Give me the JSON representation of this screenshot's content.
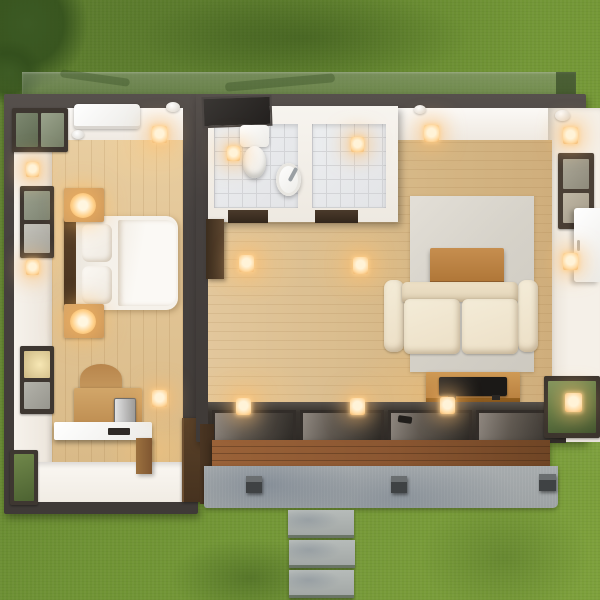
{
  "scene": {
    "type": "3d-architectural-render",
    "view": "top-down cutaway of a small container-style house on a lawn",
    "rooms": [
      {
        "name": "bedroom",
        "floor": "light wood with white tiled lounge strip"
      },
      {
        "name": "bathroom",
        "floor": "grey ceramic tile",
        "sections": [
          "wc",
          "shower"
        ]
      },
      {
        "name": "living-room",
        "floor": "light wood with grey rug"
      }
    ],
    "exterior": [
      "glass canopy strip",
      "sliding glass doors",
      "wooden deck fascia",
      "concrete patio",
      "three stepping stones",
      "lawn",
      "tree canopy"
    ]
  },
  "objects": {
    "lawn": "Lawn",
    "tree": "Tree canopy",
    "canopy": "Glass canopy over rear wall",
    "bedroom": "Bedroom",
    "bed": "Double bed with white duvet",
    "headboard": "Dark wood headboard",
    "pillow": "Pillow",
    "nightstand": "Nightstand with glowing lamp",
    "desk": "Wooden desk with computer",
    "chair": "Desk chair",
    "wardrobe": "Dark wood wardrobe",
    "ac": "Air-conditioning unit",
    "window": "Window",
    "transom": "Transom window",
    "corner_glass": "Corner glazing",
    "sconce": "Wall sconce",
    "downlight": "Recessed downlight",
    "detector": "Smoke detector",
    "bathroom": "Bathroom",
    "skylight": "Bathroom skylight vent",
    "toilet": "Toilet",
    "basin": "Round wash basin",
    "shower": "Tiled shower room",
    "threshold": "Doorway threshold mat",
    "hall_door": "Wall door panel",
    "living": "Living room",
    "rug": "Area rug",
    "coffee_table": "Wooden coffee table",
    "sofa": "Two-seat cream sofa",
    "tv": "Television on media console",
    "console": "Wooden media console",
    "east_window": "Side-wall window",
    "cabinet": "Wall-mounted cabinet",
    "sliding_doors": "Sliding glass doors",
    "se_glass": "Corner glass panel",
    "deck": "Wooden deck fascia",
    "patio": "Concrete patio",
    "cube_light": "Patio cube light",
    "stone": "Concrete stepping stone"
  },
  "colors": {
    "grass": "#6f9334",
    "grass_dark": "#5e7e2f",
    "grass_light": "#7da03b",
    "tree": "#3c5a24",
    "wall_dark": "#474240",
    "wall_white": "#f4f0ea",
    "wood_furniture": "#c6935a",
    "wood_dark": "#46321f",
    "tile": "#e3e4e7",
    "tile_line": "#d3d4d7",
    "rug": "#d7d3ca",
    "sofa": "#ecdfc6",
    "tv": "#1d1b19",
    "deck_wood": "#8a5631",
    "concrete": "#9da2a4",
    "stone": "#a3a8a6",
    "glow": "#ffd9a0",
    "glow_core": "#fff3d8"
  }
}
